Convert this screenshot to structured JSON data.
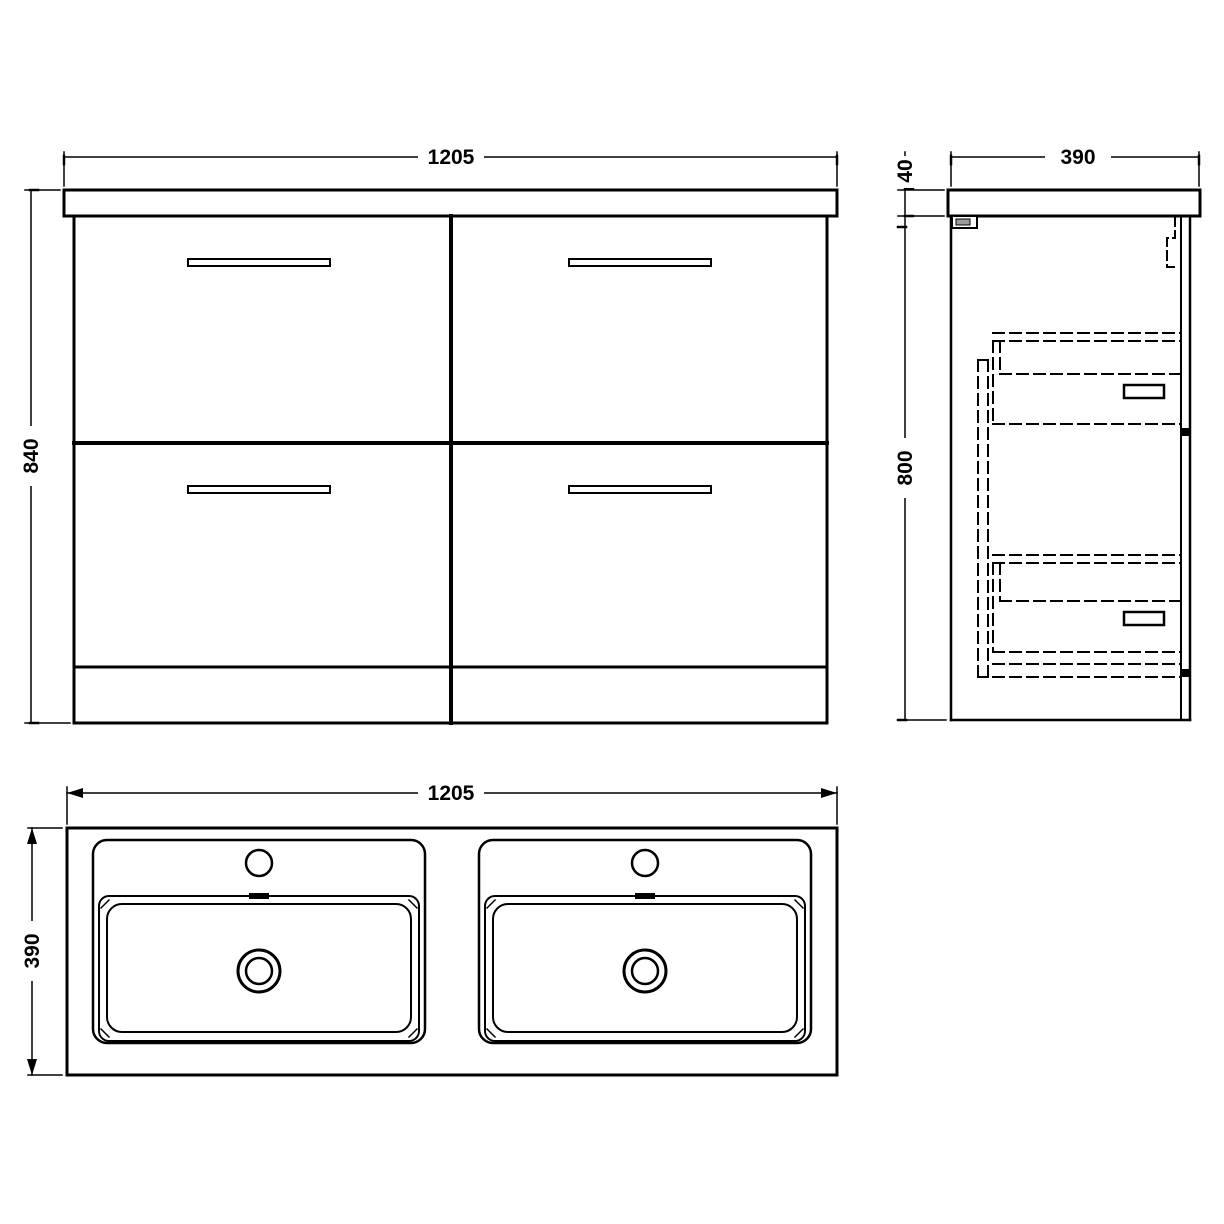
{
  "drawing": {
    "type": "technical-dimension-drawing",
    "subject": "double-basin vanity unit with four drawers",
    "background_color": "#ffffff",
    "line_color": "#000000",
    "views": {
      "front": {
        "width_mm": "1205",
        "height_mm": "840"
      },
      "side": {
        "depth_mm": "390",
        "worktop_thickness_mm": "40",
        "body_height_mm": "800"
      },
      "plan": {
        "width_mm": "1205",
        "depth_mm": "390"
      }
    }
  }
}
